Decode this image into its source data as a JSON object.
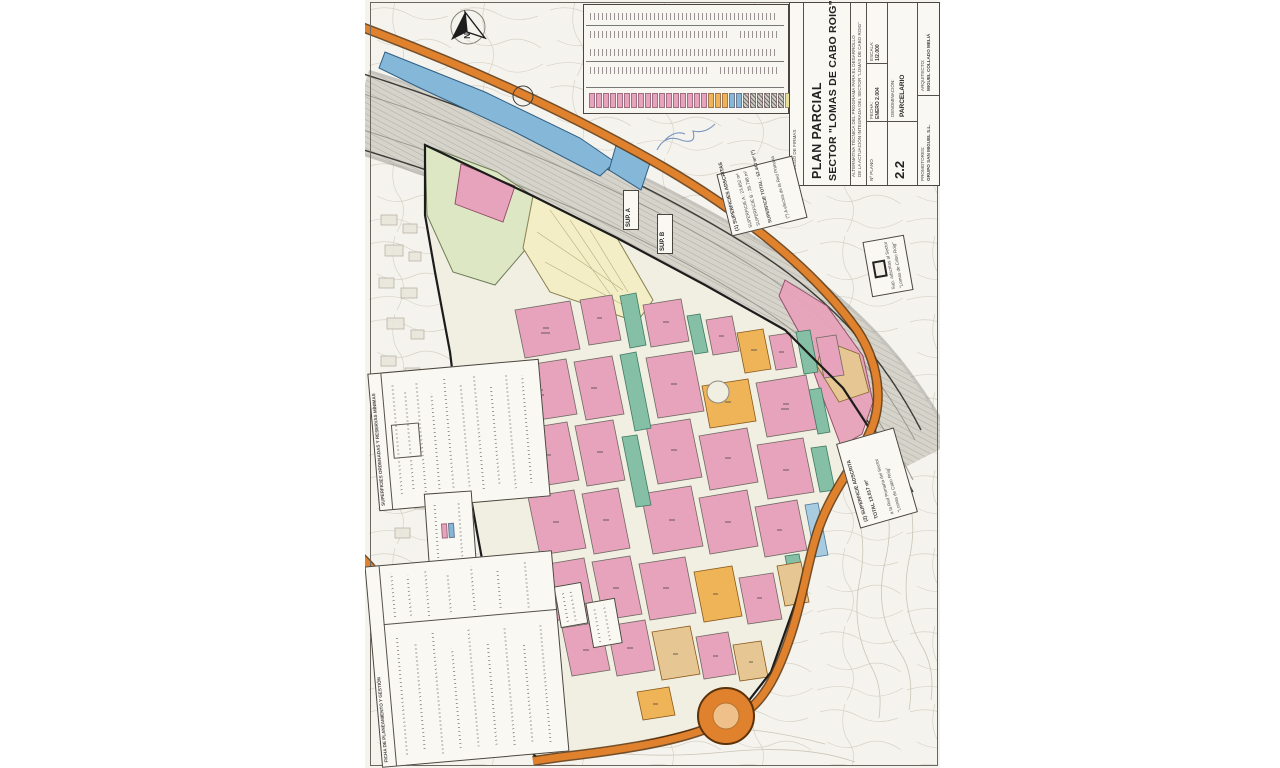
{
  "palette": {
    "residential_pink": "#e8a3bc",
    "green_zone_teal": "#84bfa6",
    "tertiary_orange": "#efb457",
    "tan_parcel": "#e6c793",
    "equipment_cream": "#f3eec6",
    "public_green": "#dde7c4",
    "infrastructure_blue": "#85b7d9",
    "road_orange": "#e0812e",
    "highway_grey": "#d6d3ca",
    "paper": "#f5f3ed"
  },
  "north_arrow": {
    "label": "N"
  },
  "title_block": {
    "signatures_label": "PLIEGO DE FIRMAS",
    "title_line1": "PLAN PARCIAL",
    "title_line2": "SECTOR \"LOMAS DE CABO ROIG\"",
    "subtitle_line1": "ALTERNATIVA TÉCNICA DEL PROGRAMA PARA EL DESARROLLO",
    "subtitle_line2": "DE LA ACTUACIÓN INTEGRADA DEL SECTOR \"LOMAS DE CABO ROIG\"",
    "escala_label": "ESCALA:",
    "escala_value": "1/2.000",
    "fecha_label": "FECHA:",
    "fecha_value": "ENERO 2.004",
    "plano_label": "Nº PLANO",
    "plano_number": "2.2",
    "denominacion_label": "DENOMINACIÓN:",
    "denominacion_value": "PARCELARIO",
    "arquitecto_label": "ARQUITECTO:",
    "arquitecto_value": "MIGUEL COLLADO MELIÁ",
    "promotores_label": "PROMOTORES:",
    "promotores_value": "GRUPO SAN MIGUEL S.L."
  },
  "legend_table": {
    "swatch_groups": [
      {
        "name": "residencial",
        "color": "#e8a3bc",
        "count": 17
      },
      {
        "name": "terciario",
        "color": "#efb457",
        "count": 3
      },
      {
        "name": "infraestructura",
        "color": "#85b7d9",
        "count": 2
      },
      {
        "name": "viario",
        "color": "#cfccc4",
        "count": 6,
        "hatch": true
      },
      {
        "name": "equipamiento",
        "color": "#e8df9a",
        "count": 2
      },
      {
        "name": "zonas-verdes",
        "color": "#84bfa6",
        "count": 4
      }
    ]
  },
  "map_mini_legend": {
    "swatch_groups": [
      {
        "name": "residencial",
        "color": "#e8a3bc",
        "count": 1
      },
      {
        "name": "dotacional",
        "color": "#85b7d9",
        "count": 1
      }
    ]
  },
  "annotation_boxes": {
    "box1": {
      "heading": "(1) SUPERFICIES ADSCRITAS",
      "line1": "SUPERFICIE A : 23.652 m²",
      "line2": "SUPERFICIE B : 28.788 m²",
      "line3": "SUPERFICIE TOTAL : 52.440 m² (*)",
      "note": "(*) A efectos de la Red Primaria"
    },
    "box2": {
      "heading": "(2) SUPERFICIE ADSCRITA",
      "line1": "TOTAL 13.017 m²",
      "note1": "a la Red Primaria del Sector",
      "note2": "\"Lomas de Cabo Roig\""
    },
    "mini_legend_line1": "Sup. adscritas al Sector",
    "mini_legend_line2": "\"Lomas de Cabo Roig\"",
    "sup_a": "SUP. A",
    "sup_b": "SUP. B"
  },
  "side_tables": {
    "ordenadas_title": "SUPERFICIES ORDENADAS Y RESERVAS MÍNIMAS",
    "ficha_title": "FICHA DE PLANEAMIENTO Y GESTIÓN"
  }
}
